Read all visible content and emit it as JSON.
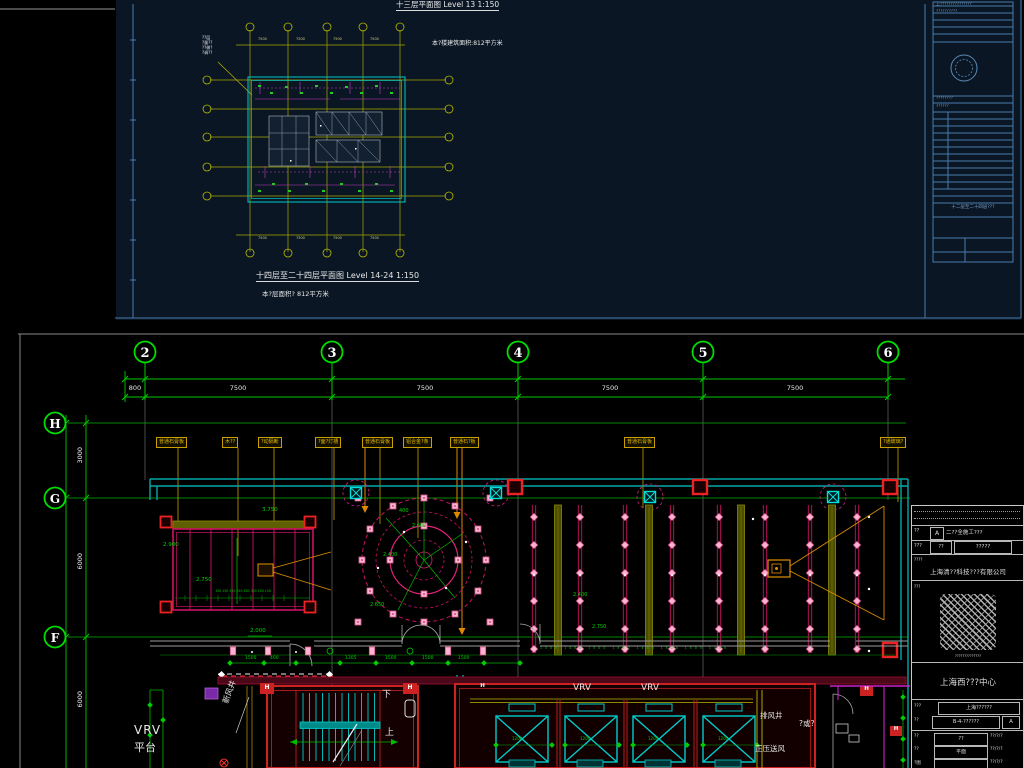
{
  "top_sheet": {
    "title": "十三层平面图  Level 13 1:150",
    "area_note": "本?楼建筑面积:812平方米",
    "plan_dim": "7500",
    "plan_note": [
      "??层",
      "?量??",
      "??做?",
      "?调??"
    ],
    "bottom_title": "十四层至二十四层平面图 Level 14-24 1:150",
    "bottom_area_note": "本?层面积?  812平方米",
    "titleblock": {
      "line1": "上???????????????",
      "line2": "??????????",
      "line3": "????????",
      "line4": "??????",
      "sheet_title": "十二层至二十四层???"
    }
  },
  "bottom_sheet": {
    "grid_cols": [
      "2",
      "3",
      "4",
      "5",
      "6"
    ],
    "col_dims": [
      "800",
      "7500",
      "7500",
      "7500",
      "7500"
    ],
    "grid_rows": [
      "H",
      "G",
      "F"
    ],
    "row_dims": [
      "3000",
      "6000",
      "6000"
    ],
    "callouts": [
      "普通石膏板",
      "木??",
      "?动隔断",
      "?面?灯槽",
      "普通石膏板",
      "铝合金?条",
      "普通石?板",
      "普通石膏板",
      "?通玻璃?"
    ],
    "elevations": {
      "hall_top": "3.750",
      "room_left": "2.900",
      "room_mid": "2.750",
      "circle_r": "400",
      "circle_top": "2.600",
      "circle_mid": "2.400",
      "circle_bot": "2.650",
      "right_a": "2.400",
      "right_b": "2.750",
      "corridor": "2.000"
    },
    "batten_dims": "150 150 300 150 150 300 150 150",
    "hall_dims": "1500   1450   1500   1500   1450   1500   1500   1450",
    "floor_dims": [
      "1500",
      "400",
      "1305",
      "1500",
      "1500",
      "1500"
    ],
    "elevator_dim": "1200",
    "labels": {
      "vrv": "VRV",
      "platform": "平台",
      "fresh_air_shaft": "新风井",
      "down": "下",
      "up": "上",
      "vrv_a": "VRV",
      "vrv_b": "VRV",
      "exhaust_shaft": "排风井",
      "room_q": "?或?",
      "pressurized_air": "正压送风",
      "col_tag": "H"
    },
    "titleblock": {
      "row1_label": "??",
      "row1_a": "A",
      "row1_title": "二??全施工???",
      "row2_label": "???",
      "row2_box": "??",
      "row2_val": "?????",
      "note1": "????",
      "company": "上海清??科技???有限公司",
      "note2": "???",
      "stamp_note": "??????????????",
      "project": "上海西???中心",
      "row3_label": "???",
      "row3_val": "上海??????",
      "row4_label": "??",
      "row4_val": "B-4-??????",
      "row4_a": "A",
      "small_rows": [
        {
          "label": "??",
          "value": "??",
          "date": "??/?/?"
        },
        {
          "label": "??",
          "value": "平面",
          "date": "??/?/?"
        },
        {
          "label": "?图",
          "value": "",
          "date": "??/?/?"
        }
      ]
    }
  }
}
